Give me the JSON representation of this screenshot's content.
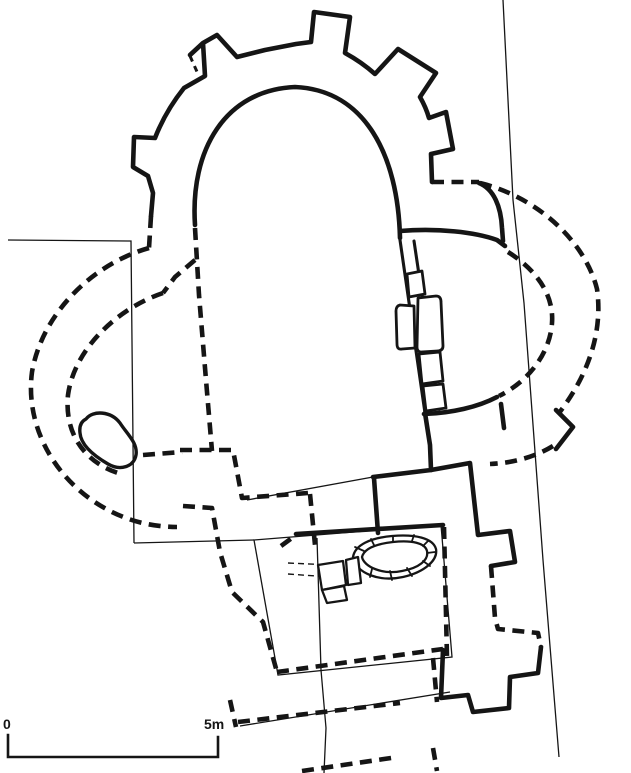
{
  "scale_bar": {
    "start_label": "0",
    "end_label": "5m"
  },
  "colors": {
    "ink": "#151515",
    "paper": "#ffffff"
  },
  "features": [
    {
      "name": "rotunda-outer-wall-with-buttresses",
      "line_style": "solid"
    },
    {
      "name": "rotunda-apse-inner-wall",
      "line_style": "solid"
    },
    {
      "name": "west-conch-outer-foundation",
      "line_style": "dashed"
    },
    {
      "name": "west-conch-inner-foundation",
      "line_style": "dashed"
    },
    {
      "name": "east-conch-outer-foundation",
      "line_style": "dashed"
    },
    {
      "name": "east-conch-inner-foundation",
      "line_style": "dashed"
    },
    {
      "name": "nave-west-wall",
      "line_style": "dashed"
    },
    {
      "name": "nave-east-wall-with-door-blocks",
      "line_style": "solid"
    },
    {
      "name": "south-room-walls",
      "line_style": "dashed"
    },
    {
      "name": "east-room-walls",
      "line_style": "solid-and-dashed"
    },
    {
      "name": "south-porch",
      "line_style": "solid"
    },
    {
      "name": "grave-stone-setting",
      "line_style": "solid"
    },
    {
      "name": "wall-fragment-in-west-conch",
      "line_style": "solid"
    },
    {
      "name": "excavation-trench-lines",
      "line_style": "thin"
    },
    {
      "name": "scale-bar",
      "line_style": "solid"
    }
  ]
}
